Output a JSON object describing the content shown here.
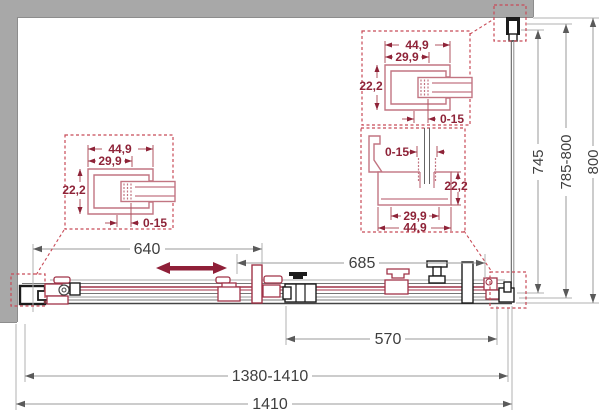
{
  "detail_left": {
    "width_outer": "44,9",
    "width_inner": "29,9",
    "height": "22,2",
    "adjust_range": "0-15"
  },
  "detail_top_right": {
    "width_outer": "44,9",
    "width_inner": "29,9",
    "height": "22,2",
    "adjust_range": "0-15"
  },
  "detail_corner": {
    "adjust_range": "0-15",
    "height": "22,2",
    "width_inner": "29,9",
    "width_outer": "44,9"
  },
  "plan_dimensions": {
    "left_fixed_segment": "640",
    "door_panel": "685",
    "opening": "570",
    "width_adjust": "1380-1410",
    "width_total": "1410"
  },
  "side_dimensions": {
    "glass_depth": "745",
    "depth_adjust": "785-800",
    "depth_total": "800"
  },
  "colors": {
    "wall_gray": "#a8a8a8",
    "dim_text": "#3f3f3f",
    "detail_red_text": "#8e2338",
    "profile_rose": "#c27582",
    "slide_arrow_red": "#8f1f38",
    "hardware_red": "#a03348",
    "hardware_black": "#1c1c1c",
    "callout_dash_red": "#c84a57"
  }
}
